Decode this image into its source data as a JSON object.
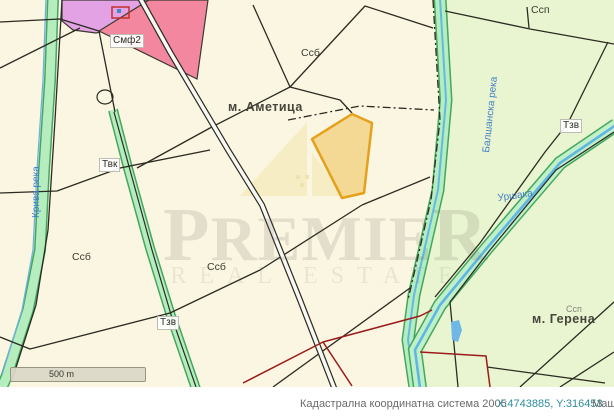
{
  "map": {
    "labels": [
      {
        "text": "Смф2",
        "x": 110,
        "y": 34,
        "cls": "chip"
      },
      {
        "text": "Ссб",
        "x": 301,
        "y": 47,
        "cls": "plain"
      },
      {
        "text": "м. Аметица",
        "x": 228,
        "y": 100,
        "cls": "area"
      },
      {
        "text": "Твк",
        "x": 99,
        "y": 158,
        "cls": "chip"
      },
      {
        "text": "Ссб",
        "x": 72,
        "y": 251,
        "cls": "plain"
      },
      {
        "text": "Ссб",
        "x": 207,
        "y": 261,
        "cls": "plain"
      },
      {
        "text": "Тзв",
        "x": 157,
        "y": 316,
        "cls": "chip"
      },
      {
        "text": "Тзв",
        "x": 560,
        "y": 119,
        "cls": "chip"
      },
      {
        "text": "Ссп",
        "x": 531,
        "y": 4,
        "cls": "plain"
      },
      {
        "text": "Ссп",
        "x": 566,
        "y": 304,
        "cls": "plain-small"
      },
      {
        "text": "м. Герена",
        "x": 532,
        "y": 312,
        "cls": "area"
      },
      {
        "text": "Крива река",
        "x": 31,
        "y": 218,
        "cls": "river-v",
        "rot": -90
      },
      {
        "text": "Балшанска река",
        "x": 481,
        "y": 152,
        "cls": "river-v",
        "rot": -84
      },
      {
        "text": "Уршака",
        "x": 497,
        "y": 193,
        "cls": "river-h",
        "rot": -8
      }
    ],
    "scalebar": {
      "label": "500 m"
    },
    "watermark": {
      "line1_start": "P",
      "line1_mid": "REMIE",
      "line1_end": "R",
      "line2": "REAL ESTATE"
    }
  },
  "statusbar": {
    "system_label": "Кадастрална координатна система 2005",
    "coordinates": "X:4743885, Y:316453",
    "scale_label": "Мащ"
  },
  "colors": {
    "parcel_cream": "#fbf6e2",
    "parcel_green": "#e9f5d1",
    "zone_pink": "#f2879f",
    "zone_violet": "#e2a2e4",
    "highlight_fill": "#f2cf7a",
    "highlight_border": "#e5a11c",
    "river_band": "#b5edbf",
    "river_band_edge": "#44a65f",
    "water_blue": "#6fb8e6",
    "boundary_black": "#2b2b22",
    "boundary_red": "#9b1b1b",
    "status_teal": "#2e8da0"
  }
}
